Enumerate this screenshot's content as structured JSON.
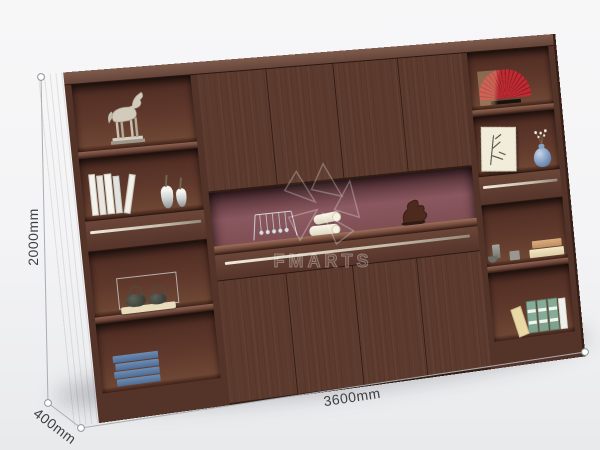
{
  "scene": {
    "type": "furniture-product-render",
    "background_color": "#f2f3f5",
    "product": "wall bookcase cabinet, dark walnut wood"
  },
  "watermark": {
    "brand": "FMARTS",
    "logo": "pinwheel-star",
    "color": "#ffffff"
  },
  "dimensions": {
    "height": "2000mm",
    "width": "3600mm",
    "depth": "400mm"
  },
  "cabinet": {
    "wood_color": "#5d3a2e",
    "side_panel_color": "#452a20",
    "top_face_color": "#755648",
    "niche_back_color": "#82525a",
    "handle_strip_color": "#d9d0c2",
    "left_tower_shelves": [
      "silver-horse-statue",
      "white-books-and-two-ceramic-vases",
      "drawer-with-metal-strip",
      "two-iron-teapots-on-wooden-stand",
      "stack-of-blue-books"
    ],
    "center_section": [
      "four-door-upper-cabinet",
      "open-niche-with-newtons-cradle-rolled-towels-and-wood-sculpture",
      "drawer-band",
      "four-door-lower-cabinet"
    ],
    "right_tower_shelves": [
      "red-folding-fan-on-stand",
      "bamboo-ink-painting-and-blue-vase-with-blossoms",
      "drawer-with-metal-strip",
      "gray-cups-and-tan-books",
      "green-and-tan-books"
    ]
  }
}
